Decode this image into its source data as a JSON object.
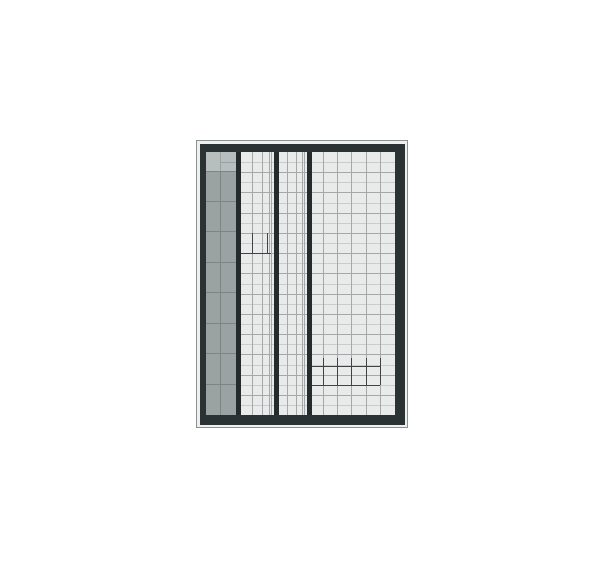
{
  "meta": {
    "description": "Zoomed-out thumbnail of an empty ledger/spreadsheet grid page",
    "page_background": "#ffffff"
  },
  "panel": {
    "x": 196,
    "y": 140,
    "width": 212,
    "height": 288,
    "colors": {
      "outline": "#8a9191",
      "mat": "#edf0ef",
      "frame": "#2b3233",
      "cell_bg": "#e9ebeb"
    },
    "mat_inset": {
      "left": 1,
      "top": 1,
      "right": 1,
      "bottom": 1
    },
    "frame_inset": {
      "left": 3,
      "top": 3,
      "right": 2,
      "bottom": 2
    },
    "content_inset": {
      "left": 6,
      "top": 8,
      "right": 10,
      "bottom": 10
    }
  },
  "grid": {
    "width": 189,
    "height": 263,
    "header_column": {
      "x": 0,
      "width": 30,
      "bg": "#9aa2a2",
      "line_color": "#7d8585",
      "center_divider_x": 14,
      "row_divider_ys": [
        19,
        49,
        79,
        110,
        140,
        171,
        201,
        232
      ],
      "top_block": {
        "height": 19,
        "bg": "#b8bebe",
        "line_color": "#9aa2a2",
        "divider_x": 14,
        "right_split_y": 10
      }
    },
    "h_lines": {
      "x1": 30,
      "x2": 189,
      "spacing": 10.12,
      "count": 25,
      "light": "#c8cccc",
      "dark": "#a3a9a9"
    },
    "thick_dividers": {
      "color": "#242b2c",
      "width": 5,
      "xs": [
        30,
        68,
        101
      ]
    },
    "sections": [
      {
        "name": "left-section",
        "vline_xs": [
          46,
          56,
          62.5,
          65
        ]
      },
      {
        "name": "middle-section",
        "vline_xs": [
          81,
          90,
          95.5,
          98
        ]
      },
      {
        "name": "right-section",
        "vline_xs": [
          116.5,
          131,
          145,
          159.5,
          174
        ]
      }
    ],
    "vline_color": "#a3a9a9",
    "dark_marks": {
      "color": "#3d4445",
      "hlines": [
        {
          "x1": 35,
          "x2": 65,
          "y": 101
        },
        {
          "x1": 106,
          "x2": 174,
          "y": 214
        },
        {
          "x1": 106,
          "x2": 174,
          "y": 233
        }
      ],
      "vlines": [
        {
          "x": 46,
          "y1": 81,
          "y2": 101
        },
        {
          "x": 61,
          "y1": 81,
          "y2": 101
        },
        {
          "x": 116.5,
          "y1": 206,
          "y2": 233
        },
        {
          "x": 131,
          "y1": 206,
          "y2": 233
        },
        {
          "x": 145,
          "y1": 206,
          "y2": 233
        },
        {
          "x": 159.5,
          "y1": 206,
          "y2": 233
        },
        {
          "x": 174,
          "y1": 206,
          "y2": 233
        }
      ]
    }
  }
}
